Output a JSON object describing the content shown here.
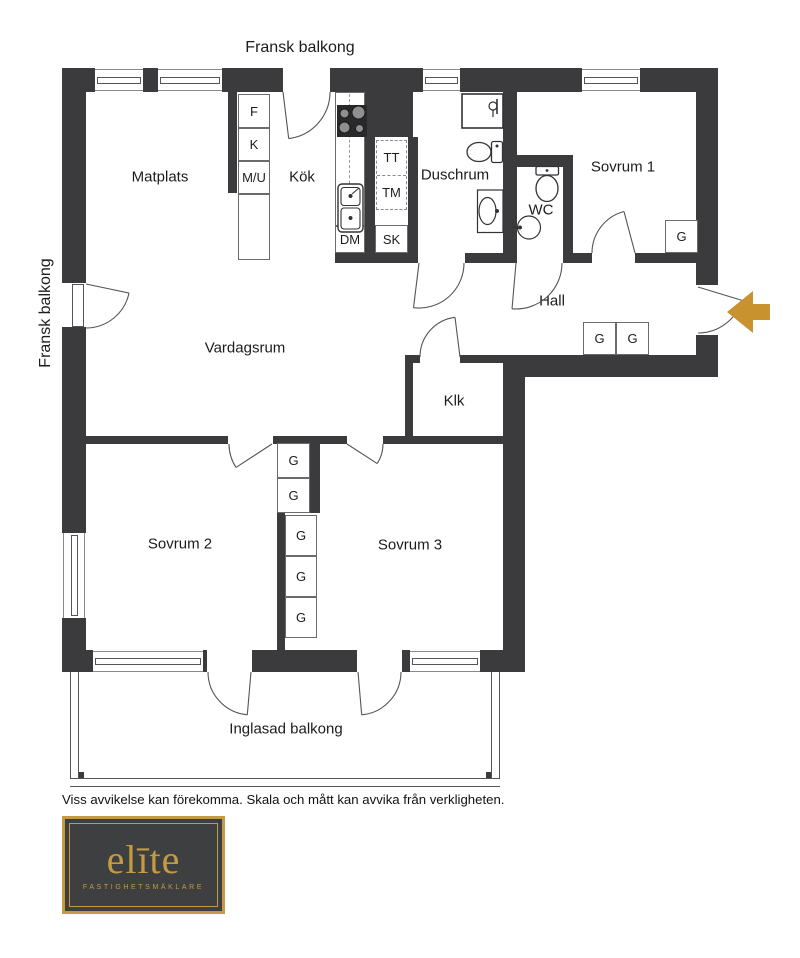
{
  "plan": {
    "title_top": "Fransk balkong",
    "title_left": "Fransk balkong",
    "rooms": {
      "matplats": "Matplats",
      "kok": "Kök",
      "duschrum": "Duschrum",
      "sovrum1": "Sovrum 1",
      "wc": "WC",
      "hall": "Hall",
      "vardagsrum": "Vardagsrum",
      "klk": "Klk",
      "sovrum2": "Sovrum 2",
      "sovrum3": "Sovrum 3",
      "inglasad_balkong": "Inglasad balkong"
    },
    "fixtures": {
      "fridge": "F",
      "freezer": "K",
      "micro_oven": "M/U",
      "tumble_dryer": "TT",
      "washing_machine": "TM",
      "dishwasher": "DM",
      "cleaning_closet": "SK",
      "wardrobe": "G"
    },
    "colors": {
      "wall": "#3B3B3D",
      "entry_arrow_gold": "#C8932F",
      "logo_gold": "#C49B42",
      "logo_background": "#3E3F41"
    }
  },
  "footer": {
    "disclaimer": "Viss avvikelse kan förekomma. Skala och mått kan avvika från verkligheten."
  },
  "logo": {
    "brand": "elīte",
    "tagline": "FASTIGHETSMÄKLARE"
  }
}
